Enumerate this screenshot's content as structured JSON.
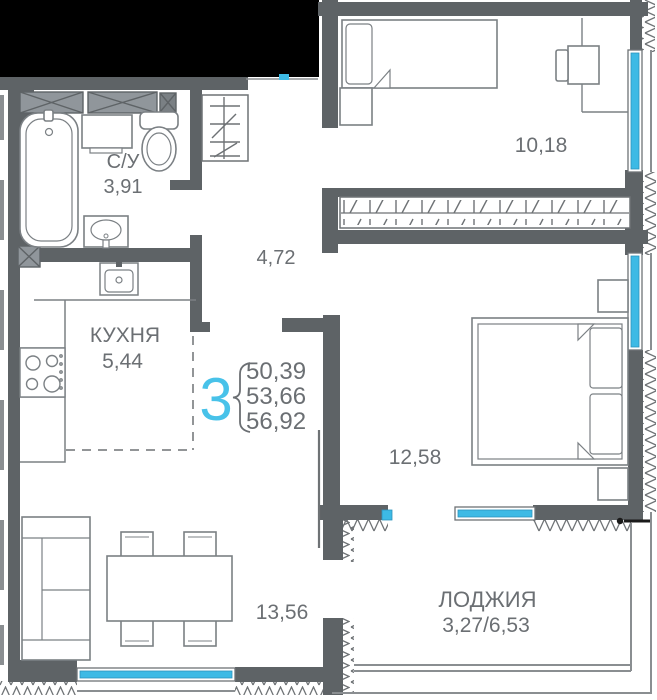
{
  "title": "apartment floor plan",
  "apartment": {
    "number": "3",
    "area_total": "50,39",
    "area_living": "53,66",
    "area_full": "56,92"
  },
  "rooms": {
    "bathroom": {
      "name": "С/У",
      "area": "3,91"
    },
    "kitchen": {
      "name": "КУХНЯ",
      "area": "5,44"
    },
    "bedroom_top": {
      "area": "10,18"
    },
    "hallway": {
      "area": "4,72"
    },
    "bedroom_right": {
      "area": "12,58"
    },
    "living": {
      "area": "13,56"
    },
    "loggia": {
      "name": "ЛОДЖИЯ",
      "area": "3,27/6,53"
    }
  },
  "colors": {
    "wall": "#5e6366",
    "window": "#3dbae5",
    "accent": "#48c2e9",
    "text": "#6b6f73",
    "outside_mass": "#000000"
  }
}
